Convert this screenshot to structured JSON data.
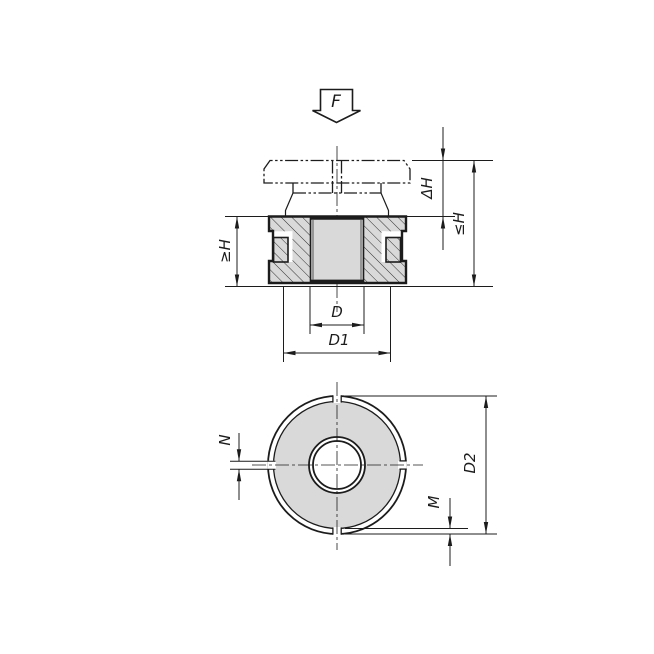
{
  "colors": {
    "background": "#ffffff",
    "line": "#1c1c1c",
    "section_fill": "#d9d9d9"
  },
  "drawing": {
    "force_label": "F",
    "section_view": {
      "dims": {
        "travel": "ΔH",
        "height_max": "≤H",
        "height_min": "≥H",
        "bore_diameter": "D",
        "core_diameter": "D1"
      }
    },
    "top_view": {
      "dims": {
        "outer_diameter": "D2",
        "slot_width": "N",
        "rim_depth": "M"
      }
    }
  }
}
